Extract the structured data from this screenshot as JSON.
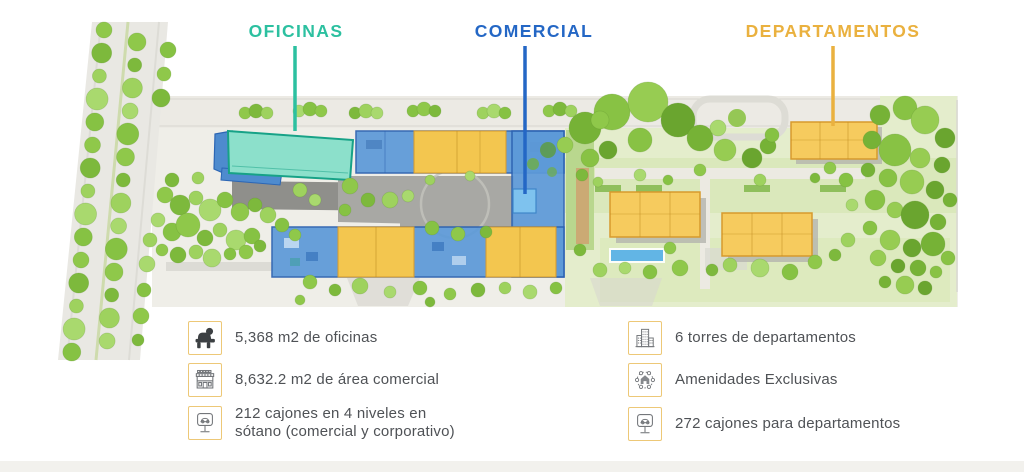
{
  "plan": {
    "title_labels": [
      {
        "id": "oficinas",
        "text": "OFICINAS",
        "color": "#2cc0a0"
      },
      {
        "id": "comercial",
        "text": "COMERCIAL",
        "color": "#2467c5"
      },
      {
        "id": "departamentos",
        "text": "DEPARTAMENTOS",
        "color": "#eab13f"
      }
    ]
  },
  "legend": {
    "left": [
      {
        "icon": "office-worker-desk-icon",
        "text": "5,368 m2 de oficinas"
      },
      {
        "icon": "storefront-icon",
        "text": "8,632.2 m2 de área comercial"
      },
      {
        "icon": "parking-lift-icon",
        "text": "212 cajones en 4 niveles en sótano (comercial y corporativo)"
      }
    ],
    "right": [
      {
        "icon": "apartment-towers-icon",
        "text": "6 torres de departamentos"
      },
      {
        "icon": "amenities-icon",
        "text": "Amenidades Exclusivas"
      },
      {
        "icon": "parking-lift-icon",
        "text": "272 cajones para departamentos"
      }
    ]
  },
  "colors": {
    "offices_building": "#8ce0cb",
    "commercial_building": "#5d9ad8",
    "apartments_building": "#f6cb5e",
    "legend_border": "#edc877",
    "legend_text": "#4f5256",
    "footer_strip": "#f2f1ed"
  }
}
